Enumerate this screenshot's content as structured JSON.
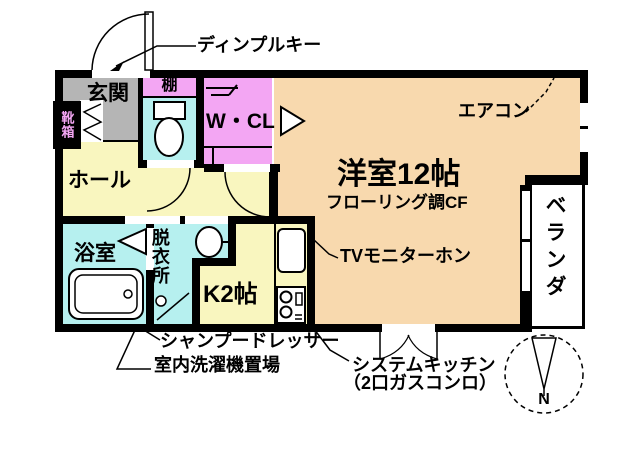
{
  "colors": {
    "wall": "#000000",
    "background": "#FFFFFF",
    "room_peach": "#F8D9AE",
    "room_pink": "#F3A6F3",
    "room_cyan": "#B6F0EF",
    "room_yellow": "#F9F6BF",
    "genkan_gray": "#B5B5B5"
  },
  "rooms": {
    "genkan": {
      "label": "玄関"
    },
    "shoe_box": {
      "label": "靴箱"
    },
    "toilet_shelf": {
      "label": "棚"
    },
    "walk_in_closet": {
      "label": "W・CL"
    },
    "hall": {
      "label": "ホール"
    },
    "bathroom": {
      "label": "浴室"
    },
    "dressing_room": {
      "label": "脱衣所"
    },
    "kitchen": {
      "label": "K2帖"
    },
    "western_room": {
      "label": "洋室12帖",
      "sublabel": "フローリング調CF"
    },
    "veranda": {
      "label": "ベランダ"
    }
  },
  "annotations": {
    "dimple_key": "ディンプルキー",
    "air_conditioner": "エアコン",
    "tv_monitor_phone": "TVモニターホン",
    "shampoo_dresser": "シャンプードレッサー",
    "indoor_washer_space": "室内洗濯機置場",
    "system_kitchen_line1": "システムキッチン",
    "system_kitchen_line2": "（2口ガスコンロ）"
  },
  "compass": {
    "north_label": "N"
  }
}
